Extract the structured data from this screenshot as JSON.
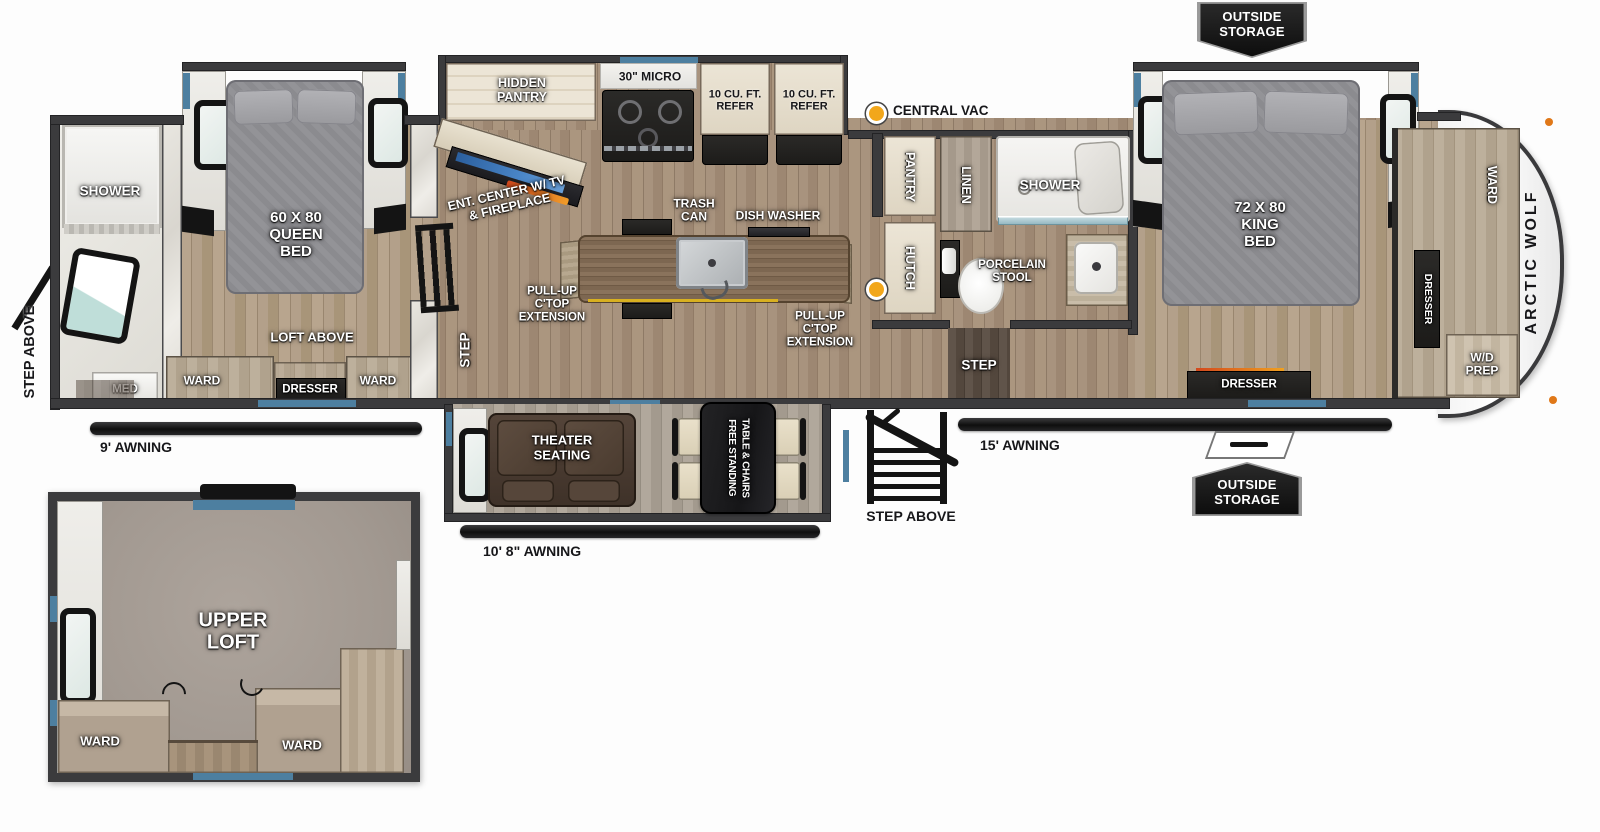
{
  "colors": {
    "accent_blue": "#4d7fa0",
    "vac_yellow": "#f2a71b",
    "badge_bg": "#111111",
    "wall_gray": "#3b3b3d"
  },
  "badges": {
    "outside_storage_top": "OUTSIDE\nSTORAGE",
    "outside_storage_bottom": "OUTSIDE\nSTORAGE"
  },
  "exterior": {
    "central_vac": "CENTRAL VAC",
    "awning_rear": "9' AWNING",
    "awning_door": "10' 8\" AWNING",
    "awning_front": "15' AWNING",
    "step_above_rear": "STEP ABOVE",
    "step_above_entry": "STEP ABOVE",
    "brand": "ARCTIC WOLF"
  },
  "rear_bath": {
    "shower": "SHOWER",
    "med": "MED"
  },
  "queen_bedroom": {
    "bed": "60 X 80\nQUEEN\nBED",
    "loft_above": "LOFT ABOVE",
    "ward_left": "WARD",
    "dresser": "DRESSER",
    "ward_right": "WARD",
    "step": "STEP"
  },
  "kitchen": {
    "hidden_pantry": "HIDDEN\nPANTRY",
    "micro": "30\" MICRO",
    "refer_left": "10 CU. FT.\nREFER",
    "refer_right": "10 CU. FT.\nREFER",
    "ent_center": "ENT. CENTER W/ TV\n& FIREPLACE",
    "trash_can": "TRASH\nCAN",
    "dish_washer": "DISH WASHER",
    "pullup_left": "PULL-UP\nC'TOP\nEXTENSION",
    "pullup_right": "PULL-UP\nC'TOP\nEXTENSION"
  },
  "mid_bath": {
    "pantry": "PANTRY",
    "linen": "LINEN",
    "shower": "SHOWER",
    "hutch": "HUTCH",
    "porcelain_stool": "PORCELAIN\nSTOOL",
    "step": "STEP"
  },
  "living": {
    "theater_seating": "THEATER\nSEATING",
    "dining_table": "FREE STANDING\nTABLE & CHAIRS"
  },
  "king_bedroom": {
    "bed": "72 X 80\nKING\nBED",
    "dresser_bottom": "DRESSER",
    "ward": "WARD",
    "dresser_side": "DRESSER",
    "wd_prep": "W/D\nPREP"
  },
  "loft": {
    "title": "UPPER\nLOFT",
    "ward_left": "WARD",
    "ward_right": "WARD"
  }
}
